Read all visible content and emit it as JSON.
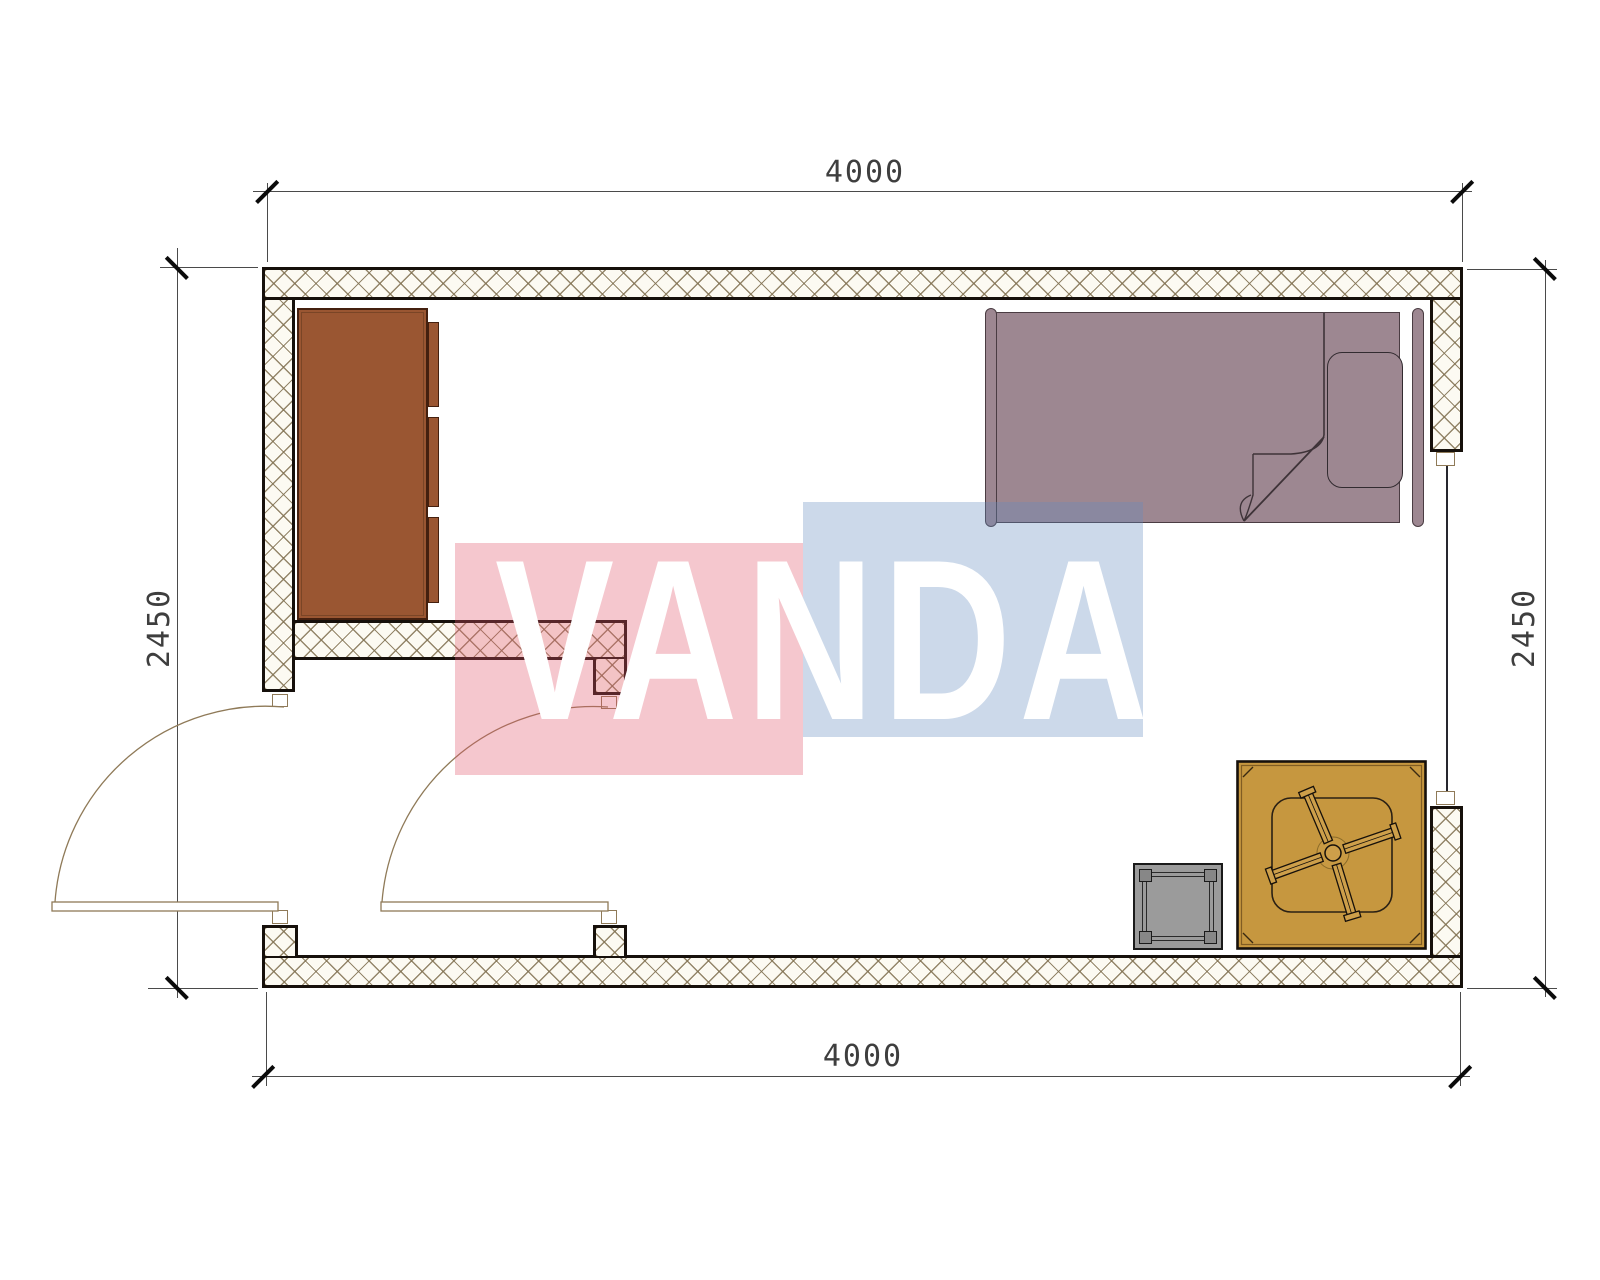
{
  "dimensions": {
    "top": "4000",
    "bottom": "4000",
    "left": "2450",
    "right": "2450"
  },
  "watermark": {
    "text": "VANDA",
    "red_block_color": "#f3c3ca",
    "blue_block_color": "#ccd8e8",
    "text_color": "#ffffff"
  },
  "furniture_symbols": {
    "wardrobe": "wardrobe-cabinet",
    "bed": "single-bed-with-pillow-and-folded-blanket",
    "table": "square-table-with-fan-symbol",
    "stool": "square-stool",
    "door_left": "entry-door-swing",
    "door_interior": "interior-door-swing",
    "window": "window-opening"
  },
  "colors": {
    "wall_outline": "#16100b",
    "wall_hatch_line": "#827252",
    "wardrobe_fill": "#9a5632",
    "bed_fill": "#9d8791",
    "table_fill": "#c6973f",
    "fan_fill": "#cd9f4a",
    "stool_fill": "#9b9b9b",
    "door_arc": "#8f7a58",
    "dimension_line": "#4a4a4a",
    "dimension_text": "#3e3e3e"
  }
}
